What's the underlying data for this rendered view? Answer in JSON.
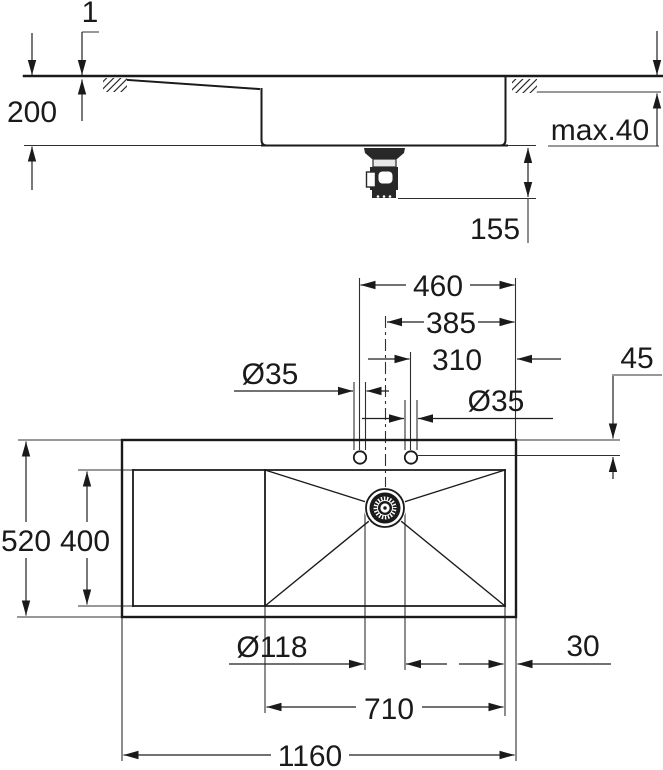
{
  "side_view": {
    "rim_height": "1",
    "bowl_depth": "200",
    "worktop_thickness": "max.40",
    "drain_height": "155"
  },
  "plan_view": {
    "hole1_to_right_edge": "460",
    "center_to_right_edge": "385",
    "hole2_to_right_edge": "310",
    "hole1_diameter": "Ø35",
    "hole2_diameter": "Ø35",
    "edge_to_hole_center": "45",
    "total_depth": "520",
    "recess_depth": "400",
    "drain_diameter": "Ø118",
    "bowl_to_right_edge": "30",
    "bowl_width": "710",
    "total_width": "1160"
  },
  "colors": {
    "line": "#1a1a1a",
    "background": "#ffffff"
  }
}
